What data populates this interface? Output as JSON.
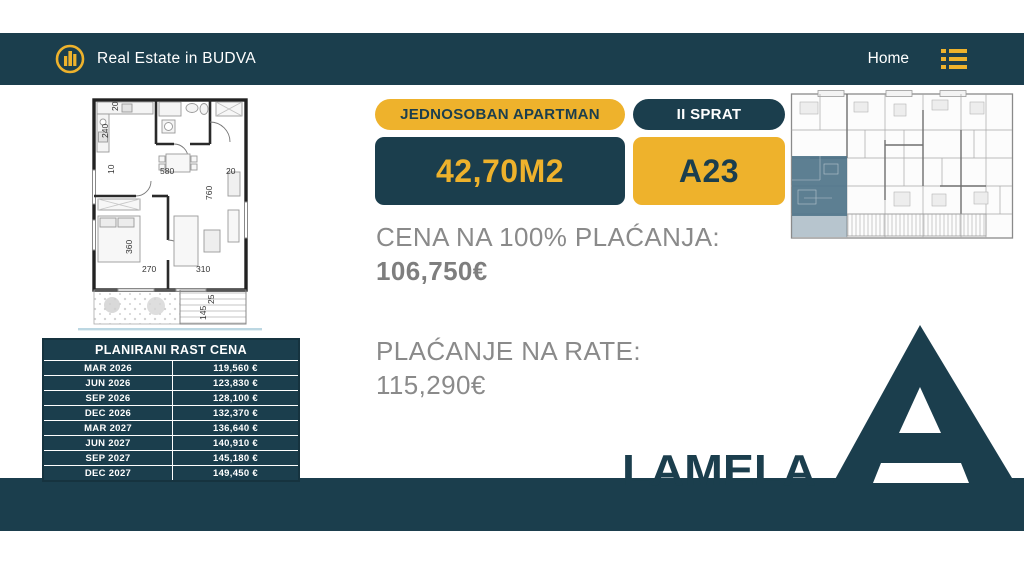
{
  "colors": {
    "teal": "#1b3e4d",
    "yellow": "#eeb22c",
    "gray_text": "#8a8a8a",
    "highlight_unit": "#4f7489"
  },
  "navbar": {
    "brand": "Real Estate in BUDVA",
    "home_label": "Home",
    "logo_icon": "buildings-in-circle-icon",
    "menu_icon": "list-menu-icon"
  },
  "listing": {
    "type_badge": "JEDNOSOBAN APARTMAN",
    "floor_badge": "II SPRAT",
    "area": "42,70M2",
    "unit": "A23",
    "full_payment_label": "CENA NA 100% PLAĆANJA:",
    "full_payment_price": "106,750€",
    "installment_label": "PLAĆANJE NA RATE:",
    "installment_price": "115,290€"
  },
  "price_table": {
    "title": "PLANIRANI RAST CENA",
    "rows": [
      {
        "month": "MAR 2026",
        "price": "119,560 €"
      },
      {
        "month": "JUN 2026",
        "price": "123,830 €"
      },
      {
        "month": "SEP 2026",
        "price": "128,100 €"
      },
      {
        "month": "DEC 2026",
        "price": "132,370 €"
      },
      {
        "month": "MAR 2027",
        "price": "136,640 €"
      },
      {
        "month": "JUN 2027",
        "price": "140,910 €"
      },
      {
        "month": "SEP 2027",
        "price": "145,180 €"
      },
      {
        "month": "DEC 2027",
        "price": "149,450 €"
      }
    ]
  },
  "floor_plan": {
    "dimensions": [
      "20",
      "240",
      "10",
      "580",
      "20",
      "760",
      "360",
      "270",
      "310",
      "145",
      "25"
    ]
  },
  "lamela": {
    "label": "LAMELA",
    "letter": "A"
  }
}
